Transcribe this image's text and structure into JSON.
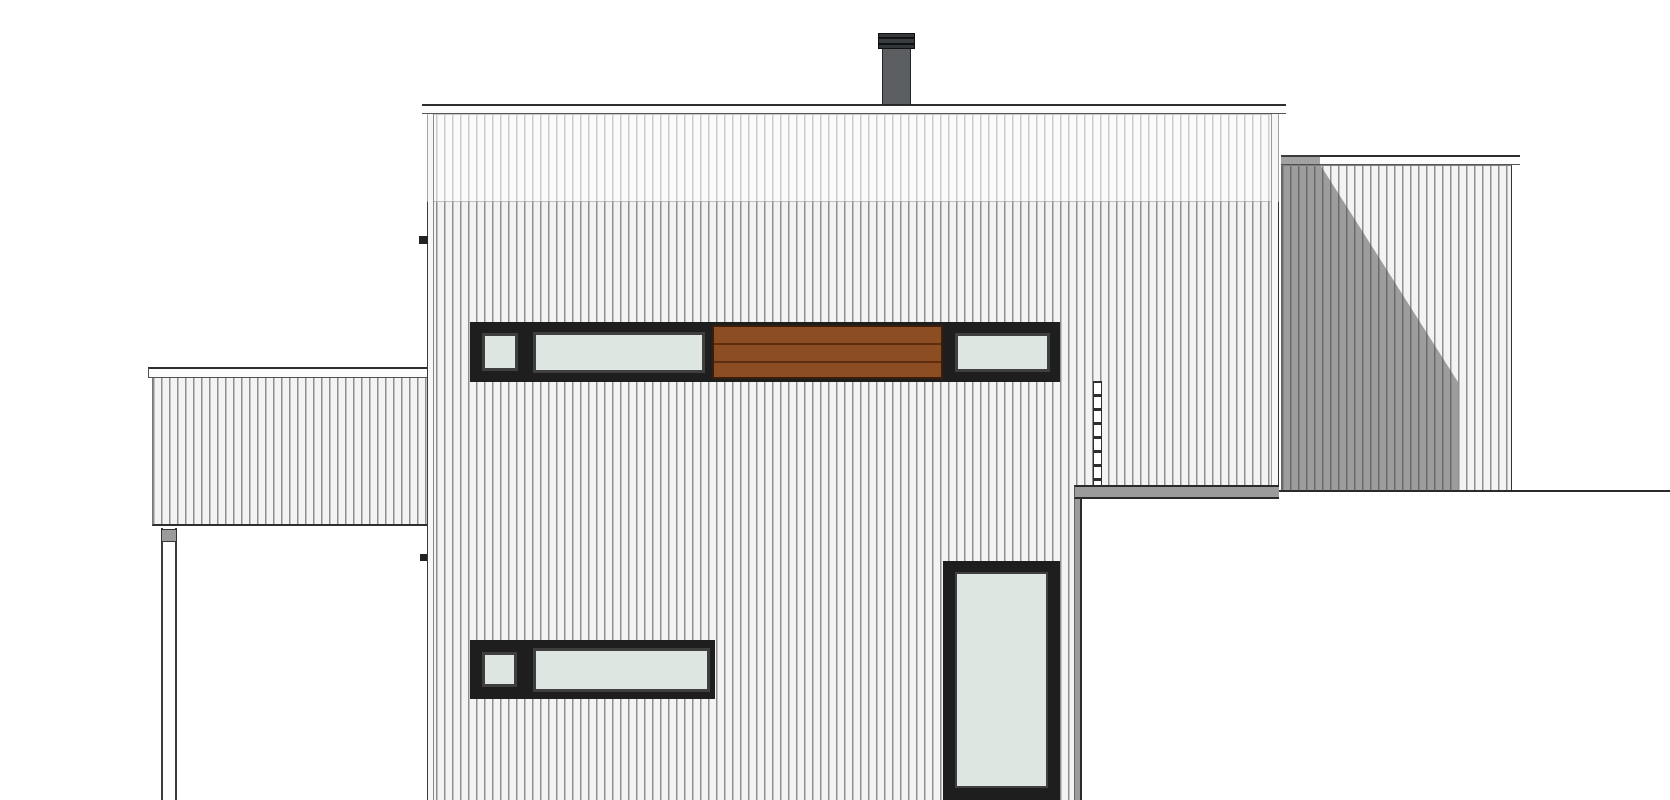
{
  "drawing": {
    "type": "architectural-elevation",
    "subject": "modern flat-roof house, side elevation with vertical板 siding, two wings and foreground garage volume",
    "visible_text": "",
    "window_count": 6,
    "has_dimension_labels": false
  },
  "palette": {
    "background": "#ffffff",
    "siding_base": "#f3f3f3",
    "siding_stripe": "#8f8f8f",
    "siding_upper_tint": "rgba(255,255,255,0.55)",
    "shadow_overlay": "rgba(72,72,72,0.5)",
    "fascia": "#fcfcfc",
    "outline_dark": "#2e2e2e",
    "window_frame": "#1e1e1e",
    "window_sash": "#3f3f3f",
    "glass": "#dde6e1",
    "wood_slat": "#8d4d22",
    "wood_slat_line": "#5e2d10",
    "chimney_body": "#5c5f61",
    "roof_edge_gray": "#9b9b9b",
    "foreground_white": "#ffffff"
  },
  "elements": [
    {
      "name": "main-building",
      "parts": [
        "roof-fascia",
        "siding-wall",
        "chimney",
        "upper-window-band",
        "wood-slat-panel",
        "lower-window-band",
        "tall-window",
        "hidden-downpipe-dashed-line"
      ]
    },
    {
      "name": "left-low-wing",
      "parts": [
        "roof-fascia",
        "siding-wall",
        "corner-post"
      ]
    },
    {
      "name": "right-background-wing",
      "parts": [
        "roof-fascia",
        "siding-wall",
        "cast-shadow"
      ]
    },
    {
      "name": "foreground-structure",
      "parts": [
        "roof-edge",
        "white-wall",
        "ground-line"
      ]
    }
  ]
}
